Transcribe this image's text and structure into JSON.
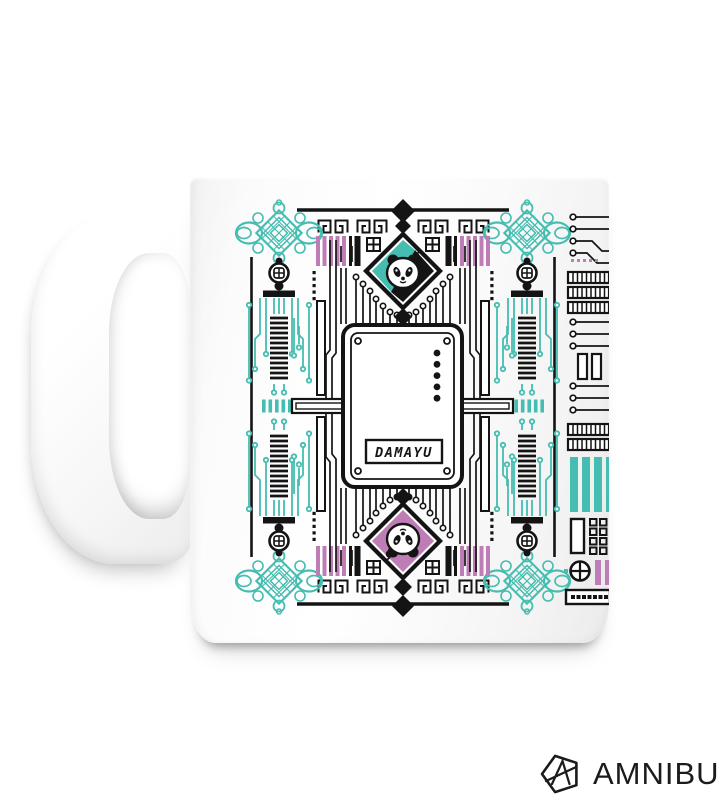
{
  "page": {
    "background": "#ffffff"
  },
  "product": {
    "item": "white ceramic mug",
    "handle_side": "left"
  },
  "brand": {
    "name": "AMNIBUS",
    "logo_icon": "pentagon-a-icon"
  },
  "design": {
    "panel_label": "DAMAYU",
    "palette": {
      "teal": "#45BDB1",
      "pink": "#BF7DB6",
      "ink": "#141414"
    },
    "motifs": [
      "panda-top-diamond-teal",
      "panda-bottom-diamond-pink",
      "chinese-knot-corners",
      "greek-key-border",
      "circuit-trace-field",
      "side-cable-modules",
      "center-circuit-panel",
      "right-edge-circuit-strip"
    ]
  }
}
